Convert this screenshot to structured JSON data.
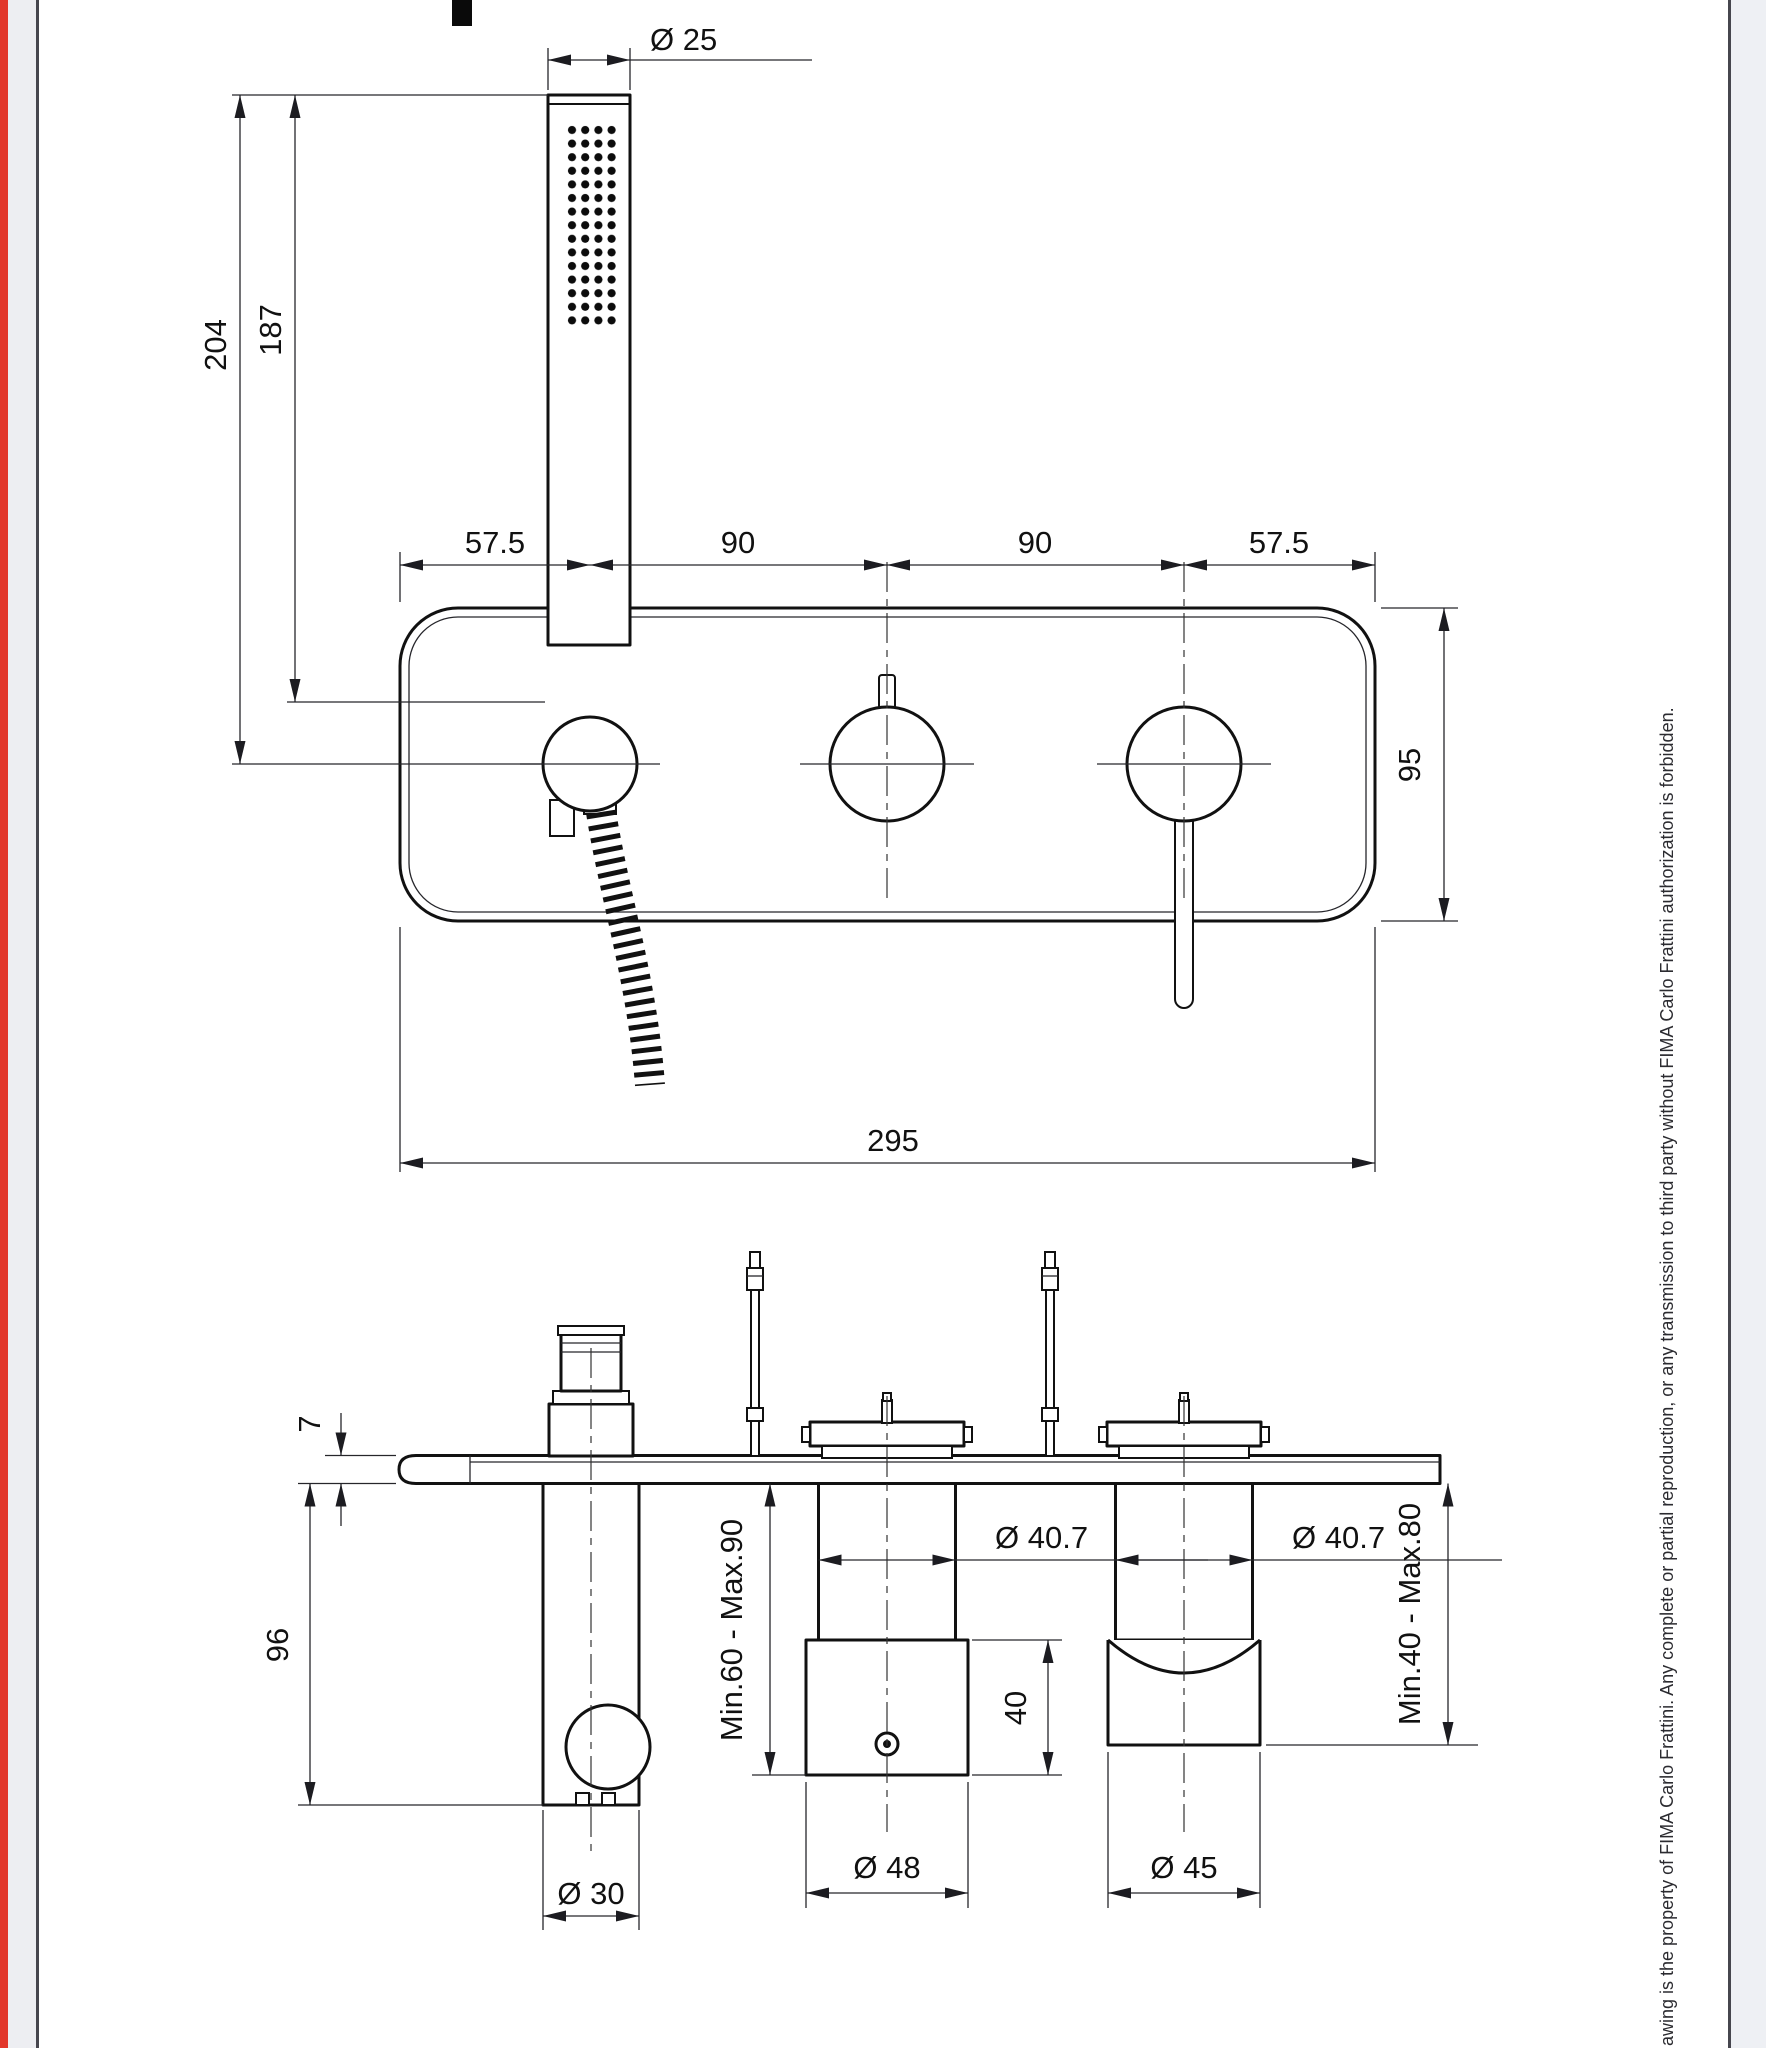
{
  "colors": {
    "accent_red": "#e2362b",
    "page_margin": "#edeef2",
    "border": "#46464e",
    "line": "#111111"
  },
  "top_view": {
    "labels": {
      "dia_handshower": "Ø 25",
      "height_total": "204",
      "height_to_holder": "187",
      "spacing_left": "57.5",
      "spacing_mid_left": "90",
      "spacing_mid_right": "90",
      "spacing_right": "57.5",
      "plate_height": "95",
      "plate_width": "295"
    }
  },
  "side_view": {
    "labels": {
      "plate_thickness": "7",
      "holder_depth": "96",
      "dia_holder_tube": "Ø 30",
      "depth_range_mid": "Min.60 - Max.90",
      "dia_cartridge_mid": "Ø 40.7",
      "body_height_mid": "40",
      "dia_body_mid": "Ø 48",
      "dia_cartridge_right": "Ø 40.7",
      "dia_body_right": "Ø 45",
      "depth_range_right": "Min.40 - Max.80"
    }
  },
  "copyright": "awing is the property of FIMA Carlo Frattini. Any complete or partial reproduction, or any transmission to third party without FIMA Carlo Frattini authorization is forbidden."
}
